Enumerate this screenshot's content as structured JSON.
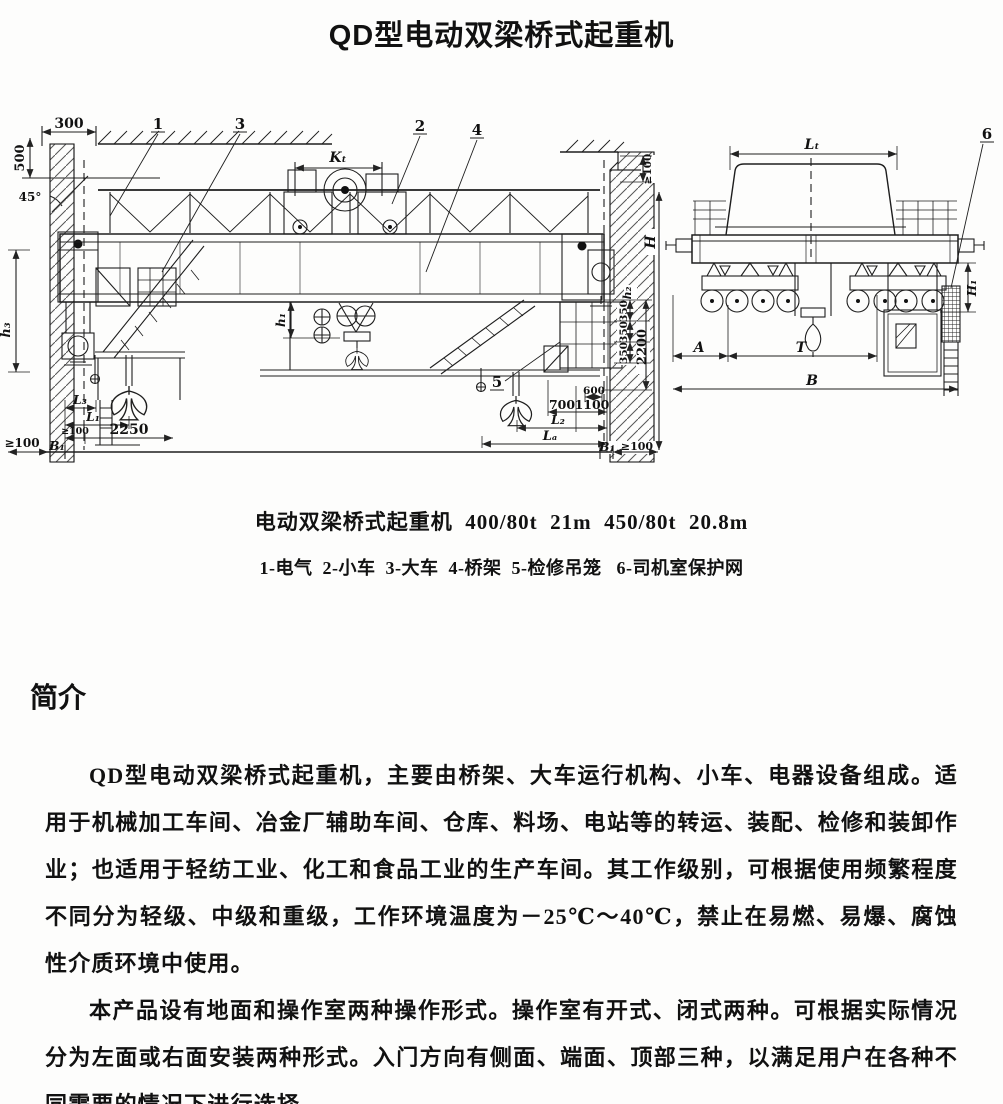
{
  "title": "QD型电动双梁桥式起重机",
  "figure": {
    "caption": "电动双梁桥式起重机  400/80t  21m  450/80t  20.8m",
    "legend": "1-电气  2-小车  3-大车  4-桥架  5-检修吊笼   6-司机室保护网"
  },
  "intro": {
    "heading": "简介",
    "p1": "QD型电动双梁桥式起重机，主要由桥架、大车运行机构、小车、电器设备组成。适用于机械加工车间、冶金厂辅助车间、仓库、料场、电站等的转运、装配、检修和装卸作业；也适用于轻纺工业、化工和食品工业的生产车间。其工作级别，可根据使用频繁程度不同分为轻级、中级和重级，工作环境温度为－25℃～40℃，禁止在易燃、易爆、腐蚀性介质环境中使用。",
    "p2": "本产品设有地面和操作室两种操作形式。操作室有开式、闭式两种。可根据实际情况分为左面或右面安装两种形式。入门方向有侧面、端面、顶部三种，以满足用户在各种不同需要的情况下进行选择。"
  },
  "labels": {
    "dim_300_top": "300",
    "dim_500": "500",
    "angle_45": "45°",
    "callout_1": "1",
    "callout_2": "2",
    "callout_3": "3",
    "callout_4": "4",
    "callout_5": "5",
    "callout_6": "6",
    "dim_kt": "Kₜ",
    "dim_lt": "Lₜ",
    "dim_geq100_wall_top": "≥100",
    "dim_H": "H",
    "dim_h1": "h₁",
    "dim_h2": "h₂",
    "dim_h3": "h₃",
    "dim_350_1": "350",
    "dim_350_2": "350",
    "dim_350_3": "350",
    "dim_2200": "2200",
    "dim_600": "600",
    "dim_700": "700",
    "dim_1100": "1100",
    "dim_L2": "L₂",
    "dim_LA": "Lₐ",
    "dim_B1_right": "B₁",
    "dim_geq100_br": "≥100",
    "dim_L3": "L₃",
    "dim_L1": "L₁",
    "dim_geq100_bl": "≥100",
    "dim_2250": "2250",
    "dim_B1_left": "B₁",
    "dim_geq100_left": "≥100",
    "dim_H1": "H₁",
    "dim_A": "A",
    "dim_T": "T",
    "dim_B": "B"
  }
}
